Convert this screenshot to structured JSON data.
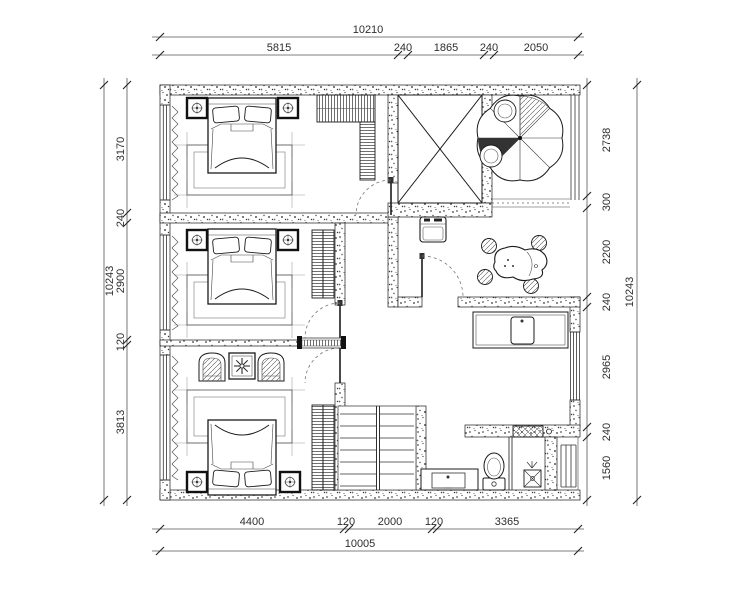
{
  "dimensions": {
    "top": {
      "total": "10210",
      "segments": [
        "5815",
        "240",
        "1865",
        "240",
        "2050"
      ]
    },
    "bottom": {
      "total": "10005",
      "segments": [
        "4400",
        "120",
        "2000",
        "120",
        "3365"
      ]
    },
    "left": {
      "total": "10243",
      "segments": [
        "3170",
        "240",
        "2900",
        "120",
        "3813"
      ]
    },
    "right": {
      "total": "10243",
      "segments": [
        "2738",
        "300",
        "2200",
        "240",
        "2965",
        "240",
        "1560"
      ]
    }
  },
  "colors": {
    "paper": "#ffffff",
    "ink": "#1b1b1b",
    "dim_text": "#2e2e2e"
  },
  "symbols": {
    "double-bed": "outlined-rect-with-pillows",
    "nightstand": "bold-square-with-lamp-circle",
    "wardrobe": "hatched-rect",
    "rug": "nested-rects",
    "armchair": "round-back-chair",
    "potted-plant": "square-with-star",
    "elevator-shaft": "rect-with-x",
    "parasol-table": "scalloped-circle-with-spokes",
    "tea-table": "organic-blob-with-stools",
    "appliance": "rounded-square",
    "kitchen-counter": "rect-with-sink",
    "staircase": "double-flight-treads",
    "toilet": "ellipse-with-tank",
    "wash-basin": "rect-with-inner-basin",
    "floor-drain": "square-with-x",
    "window": "parallel-lines",
    "curtain": "zigzag",
    "door-swing": "dashed-arc",
    "sliding-door": "hatched-track"
  }
}
